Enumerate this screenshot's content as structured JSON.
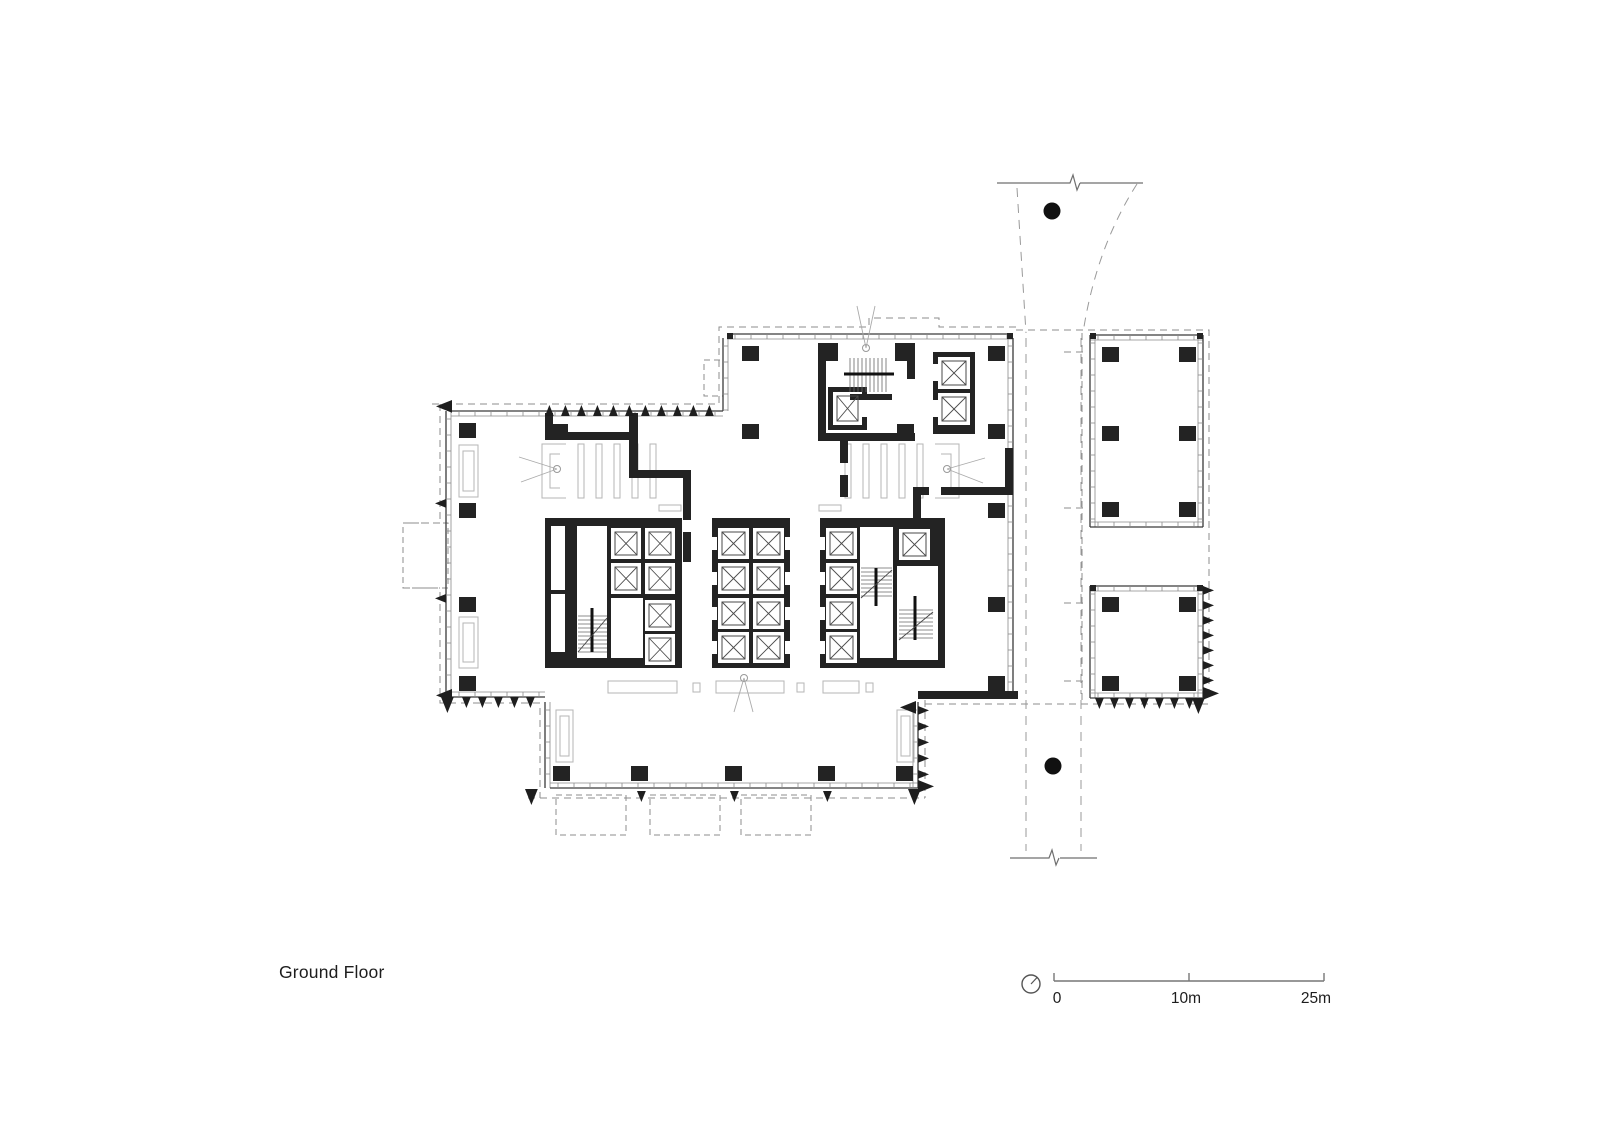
{
  "labels": {
    "plan_title": "Ground Floor",
    "scale_zero": "0",
    "scale_ten": "10m",
    "scale_twentyfive": "25m"
  },
  "icons": {
    "north_indicator": "circle-with-needle",
    "tree": "filled-circle",
    "section_break": "zigzag"
  },
  "colors": {
    "ink": "#1e1e1e",
    "wall": "#232323",
    "line": "#4a4a4a",
    "gray": "#b5b5b5",
    "dash": "#8c8c8c",
    "scale": "#777777",
    "background": "#ffffff"
  },
  "geometry": {
    "columns": [
      [
        459,
        423
      ],
      [
        459,
        503
      ],
      [
        459,
        597
      ],
      [
        459,
        676
      ],
      [
        551,
        424
      ],
      [
        742,
        346
      ],
      [
        897,
        346
      ],
      [
        988,
        346
      ],
      [
        742,
        424
      ],
      [
        897,
        424
      ],
      [
        988,
        424
      ],
      [
        988,
        503
      ],
      [
        988,
        597
      ],
      [
        988,
        676
      ],
      [
        553,
        766
      ],
      [
        631,
        766
      ],
      [
        725,
        766
      ],
      [
        818,
        766
      ],
      [
        896,
        766
      ],
      [
        1102,
        347
      ],
      [
        1179,
        347
      ],
      [
        1102,
        426
      ],
      [
        1179,
        426
      ],
      [
        1102,
        502
      ],
      [
        1179,
        502
      ],
      [
        1102,
        597
      ],
      [
        1179,
        597
      ],
      [
        1102,
        676
      ],
      [
        1179,
        676
      ]
    ],
    "column_size": [
      17,
      15
    ],
    "corner_dots": [
      [
        727,
        333
      ],
      [
        1007,
        333
      ],
      [
        1090,
        333
      ],
      [
        1197,
        333
      ],
      [
        1090,
        585
      ],
      [
        1197,
        585
      ]
    ],
    "walls": [
      [
        545,
        413,
        8,
        27
      ],
      [
        548,
        432,
        84,
        8
      ],
      [
        629,
        413,
        9,
        65
      ],
      [
        629,
        470,
        62,
        8
      ],
      [
        683,
        478,
        8,
        42
      ],
      [
        683,
        532,
        8,
        30
      ],
      [
        913,
        487,
        16,
        8
      ],
      [
        941,
        487,
        72,
        8
      ],
      [
        1005,
        448,
        8,
        39
      ],
      [
        913,
        495,
        8,
        28
      ],
      [
        918,
        691,
        100,
        8
      ],
      [
        818,
        343,
        20,
        18
      ],
      [
        895,
        343,
        20,
        18
      ],
      [
        818,
        361,
        8,
        80
      ],
      [
        818,
        433,
        97,
        8
      ],
      [
        907,
        361,
        8,
        18
      ],
      [
        850,
        394,
        42,
        6
      ],
      [
        840,
        441,
        8,
        22
      ],
      [
        840,
        475,
        8,
        22
      ]
    ],
    "core_black": [
      [
        545,
        518,
        137,
        150
      ],
      [
        712,
        518,
        78,
        150
      ],
      [
        820,
        518,
        125,
        150
      ],
      [
        828,
        387,
        39,
        43
      ],
      [
        933,
        352,
        42,
        82
      ]
    ],
    "core_white": [
      [
        551,
        526,
        14,
        64
      ],
      [
        551,
        594,
        14,
        58
      ],
      [
        577,
        526,
        30,
        132
      ],
      [
        611,
        528,
        30,
        31
      ],
      [
        645,
        528,
        30,
        31
      ],
      [
        611,
        563,
        30,
        31
      ],
      [
        645,
        563,
        30,
        31
      ],
      [
        611,
        598,
        32,
        60
      ],
      [
        645,
        600,
        30,
        31
      ],
      [
        645,
        634,
        30,
        31
      ],
      [
        718,
        528,
        31,
        31
      ],
      [
        753,
        528,
        31,
        31
      ],
      [
        718,
        563,
        31,
        31
      ],
      [
        753,
        563,
        31,
        31
      ],
      [
        718,
        598,
        31,
        31
      ],
      [
        753,
        598,
        31,
        31
      ],
      [
        718,
        632,
        31,
        31
      ],
      [
        753,
        632,
        31,
        31
      ],
      [
        712,
        537,
        5,
        13
      ],
      [
        712,
        572,
        5,
        13
      ],
      [
        712,
        607,
        5,
        13
      ],
      [
        712,
        641,
        5,
        13
      ],
      [
        785,
        537,
        5,
        13
      ],
      [
        785,
        572,
        5,
        13
      ],
      [
        785,
        607,
        5,
        13
      ],
      [
        785,
        641,
        5,
        13
      ],
      [
        826,
        528,
        31,
        31
      ],
      [
        826,
        563,
        31,
        31
      ],
      [
        826,
        598,
        31,
        31
      ],
      [
        826,
        632,
        31,
        31
      ],
      [
        860,
        527,
        33,
        131
      ],
      [
        899,
        529,
        31,
        31
      ],
      [
        897,
        566,
        41,
        94
      ],
      [
        820,
        537,
        5,
        13
      ],
      [
        820,
        572,
        5,
        13
      ],
      [
        820,
        607,
        5,
        13
      ],
      [
        820,
        641,
        5,
        13
      ],
      [
        833,
        392,
        29,
        33
      ],
      [
        862,
        399,
        5,
        18
      ],
      [
        938,
        357,
        32,
        32
      ],
      [
        938,
        393,
        32,
        32
      ],
      [
        933,
        364,
        5,
        17
      ],
      [
        933,
        400,
        5,
        17
      ]
    ],
    "shafts": [
      [
        611,
        528,
        30,
        31
      ],
      [
        645,
        528,
        30,
        31
      ],
      [
        611,
        563,
        30,
        31
      ],
      [
        645,
        563,
        30,
        31
      ],
      [
        645,
        600,
        30,
        31
      ],
      [
        645,
        634,
        30,
        31
      ],
      [
        718,
        528,
        31,
        31
      ],
      [
        753,
        528,
        31,
        31
      ],
      [
        718,
        563,
        31,
        31
      ],
      [
        753,
        563,
        31,
        31
      ],
      [
        718,
        598,
        31,
        31
      ],
      [
        753,
        598,
        31,
        31
      ],
      [
        718,
        632,
        31,
        31
      ],
      [
        753,
        632,
        31,
        31
      ],
      [
        826,
        528,
        31,
        31
      ],
      [
        826,
        563,
        31,
        31
      ],
      [
        826,
        598,
        31,
        31
      ],
      [
        826,
        632,
        31,
        31
      ],
      [
        899,
        529,
        31,
        31
      ],
      [
        833,
        392,
        29,
        33
      ],
      [
        938,
        357,
        32,
        32
      ],
      [
        938,
        393,
        32,
        32
      ]
    ],
    "stairs": [
      {
        "x": 850,
        "y": 358,
        "w": 36,
        "h": 34,
        "dir": "v",
        "rail": [
          844,
          374,
          894,
          374
        ]
      },
      {
        "x": 578,
        "y": 616,
        "w": 29,
        "h": 36,
        "dir": "h",
        "rail": [
          592,
          608,
          592,
          652
        ],
        "diag": [
          578,
          652,
          607,
          618
        ]
      },
      {
        "x": 861,
        "y": 568,
        "w": 31,
        "h": 30,
        "dir": "h",
        "rail": [
          876,
          568,
          876,
          606
        ],
        "diag": [
          861,
          598,
          892,
          570
        ]
      },
      {
        "x": 899,
        "y": 610,
        "w": 34,
        "h": 30,
        "dir": "h",
        "rail": [
          915,
          596,
          915,
          640
        ],
        "diag": [
          899,
          640,
          933,
          612
        ]
      }
    ],
    "facades": [
      {
        "x1": 451,
        "y1": 411,
        "x2": 723,
        "y2": 411,
        "nx": 0,
        "ny": 1
      },
      {
        "x1": 446,
        "y1": 411,
        "x2": 446,
        "y2": 697,
        "nx": 1,
        "ny": 0
      },
      {
        "x1": 723,
        "y1": 338,
        "x2": 723,
        "y2": 411,
        "nx": 1,
        "ny": 0
      },
      {
        "x1": 727,
        "y1": 334,
        "x2": 1013,
        "y2": 334,
        "nx": 0,
        "ny": 1
      },
      {
        "x1": 1013,
        "y1": 338,
        "x2": 1013,
        "y2": 691,
        "nx": -1,
        "ny": 0
      },
      {
        "x1": 545,
        "y1": 702,
        "x2": 545,
        "y2": 788,
        "nx": 1,
        "ny": 0
      },
      {
        "x1": 451,
        "y1": 697,
        "x2": 545,
        "y2": 697,
        "nx": 0,
        "ny": -1
      },
      {
        "x1": 550,
        "y1": 788,
        "x2": 918,
        "y2": 788,
        "nx": 0,
        "ny": -1
      },
      {
        "x1": 918,
        "y1": 702,
        "x2": 918,
        "y2": 788,
        "nx": -1,
        "ny": 0
      },
      {
        "x1": 1090,
        "y1": 335,
        "x2": 1203,
        "y2": 335,
        "nx": 0,
        "ny": 1
      },
      {
        "x1": 1090,
        "y1": 335,
        "x2": 1090,
        "y2": 527,
        "nx": 1,
        "ny": 0
      },
      {
        "x1": 1203,
        "y1": 335,
        "x2": 1203,
        "y2": 527,
        "nx": -1,
        "ny": 0
      },
      {
        "x1": 1090,
        "y1": 527,
        "x2": 1203,
        "y2": 527,
        "nx": 0,
        "ny": -1
      },
      {
        "x1": 1090,
        "y1": 586,
        "x2": 1203,
        "y2": 586,
        "nx": 0,
        "ny": 1
      },
      {
        "x1": 1090,
        "y1": 586,
        "x2": 1090,
        "y2": 698,
        "nx": 1,
        "ny": 0
      },
      {
        "x1": 1090,
        "y1": 698,
        "x2": 1203,
        "y2": 698,
        "nx": 0,
        "ny": -1
      },
      {
        "x1": 1203,
        "y1": 586,
        "x2": 1203,
        "y2": 698,
        "nx": -1,
        "ny": 0
      }
    ],
    "triangles": [
      {
        "dir": "up",
        "s": 11,
        "pts": [
          [
            545,
            416
          ],
          [
            561,
            416
          ],
          [
            577,
            416
          ],
          [
            593,
            416
          ],
          [
            609,
            416
          ],
          [
            625,
            416
          ],
          [
            641,
            416
          ],
          [
            657,
            416
          ],
          [
            673,
            416
          ],
          [
            689,
            416
          ],
          [
            705,
            416
          ]
        ]
      },
      {
        "dir": "left",
        "s": 11,
        "pts": [
          [
            446,
            499
          ],
          [
            446,
            594
          ]
        ]
      },
      {
        "dir": "down",
        "s": 11,
        "pts": [
          [
            462,
            697
          ],
          [
            478,
            697
          ],
          [
            494,
            697
          ],
          [
            510,
            697
          ],
          [
            526,
            697
          ],
          [
            637,
            791
          ],
          [
            730,
            791
          ],
          [
            823,
            791
          ]
        ]
      },
      {
        "dir": "right",
        "s": 11,
        "pts": [
          [
            918,
            706
          ],
          [
            918,
            722
          ],
          [
            918,
            738
          ],
          [
            918,
            754
          ],
          [
            918,
            770
          ]
        ]
      },
      {
        "dir": "right",
        "s": 11,
        "pts": [
          [
            1203,
            586
          ],
          [
            1203,
            601
          ],
          [
            1203,
            616
          ],
          [
            1203,
            631
          ],
          [
            1203,
            646
          ],
          [
            1203,
            661
          ],
          [
            1203,
            676
          ]
        ]
      },
      {
        "dir": "down",
        "s": 11,
        "pts": [
          [
            1095,
            698
          ],
          [
            1110,
            698
          ],
          [
            1125,
            698
          ],
          [
            1140,
            698
          ],
          [
            1155,
            698
          ],
          [
            1170,
            698
          ],
          [
            1185,
            698
          ]
        ]
      },
      {
        "dir": "left",
        "s": 16,
        "pts": [
          [
            452,
            400
          ],
          [
            452,
            689
          ],
          [
            916,
            701
          ]
        ]
      },
      {
        "dir": "down",
        "s": 16,
        "pts": [
          [
            441,
            697
          ],
          [
            525,
            789
          ],
          [
            908,
            789
          ],
          [
            1192,
            698
          ]
        ]
      },
      {
        "dir": "right",
        "s": 16,
        "pts": [
          [
            918,
            780
          ],
          [
            1203,
            687
          ]
        ]
      }
    ],
    "trees": [
      [
        1052,
        211
      ],
      [
        1053,
        766
      ]
    ],
    "louver_boxes": [
      [
        459,
        445,
        19,
        52
      ],
      [
        459,
        617,
        19,
        51
      ],
      [
        556,
        710,
        17,
        52
      ],
      [
        897,
        710,
        17,
        52
      ]
    ],
    "slat_groups": [
      {
        "x": 578,
        "y": 444,
        "n": 5,
        "dx": 18,
        "w": 6,
        "h": 54
      },
      {
        "x": 845,
        "y": 444,
        "n": 5,
        "dx": 18,
        "w": 6,
        "h": 54
      }
    ],
    "brackets": [
      {
        "x": 540,
        "y": 444,
        "flip": false
      },
      {
        "x": 933,
        "y": 444,
        "flip": true
      }
    ],
    "desks": [
      [
        608,
        681,
        69,
        12
      ],
      [
        716,
        681,
        68,
        12
      ],
      [
        823,
        681,
        36,
        12
      ],
      [
        693,
        683,
        7,
        9
      ],
      [
        797,
        683,
        7,
        9
      ],
      [
        866,
        683,
        7,
        9
      ],
      [
        659,
        505,
        22,
        6
      ],
      [
        819,
        505,
        22,
        6
      ]
    ],
    "survey_symbols": [
      {
        "cx": 557,
        "cy": 469,
        "legs": [
          [
            519,
            457
          ],
          [
            521,
            482
          ]
        ]
      },
      {
        "cx": 947,
        "cy": 469,
        "legs": [
          [
            985,
            458
          ],
          [
            983,
            483
          ]
        ]
      },
      {
        "cx": 744,
        "cy": 678,
        "legs": [
          [
            734,
            712
          ],
          [
            753,
            712
          ]
        ]
      },
      {
        "cx": 866,
        "cy": 348,
        "legs": [
          [
            857,
            306
          ],
          [
            875,
            306
          ]
        ]
      }
    ],
    "dash_rects": [
      [
        556,
        795,
        70,
        40
      ],
      [
        650,
        795,
        70,
        40
      ],
      [
        741,
        795,
        70,
        40
      ],
      [
        403,
        523,
        45,
        65
      ],
      [
        704,
        360,
        19,
        36
      ]
    ],
    "scale_bar": {
      "x0": 1054,
      "xmid": 1189,
      "x1": 1324,
      "y": 981,
      "tick": 8,
      "circle": [
        1031,
        984,
        9
      ]
    }
  }
}
